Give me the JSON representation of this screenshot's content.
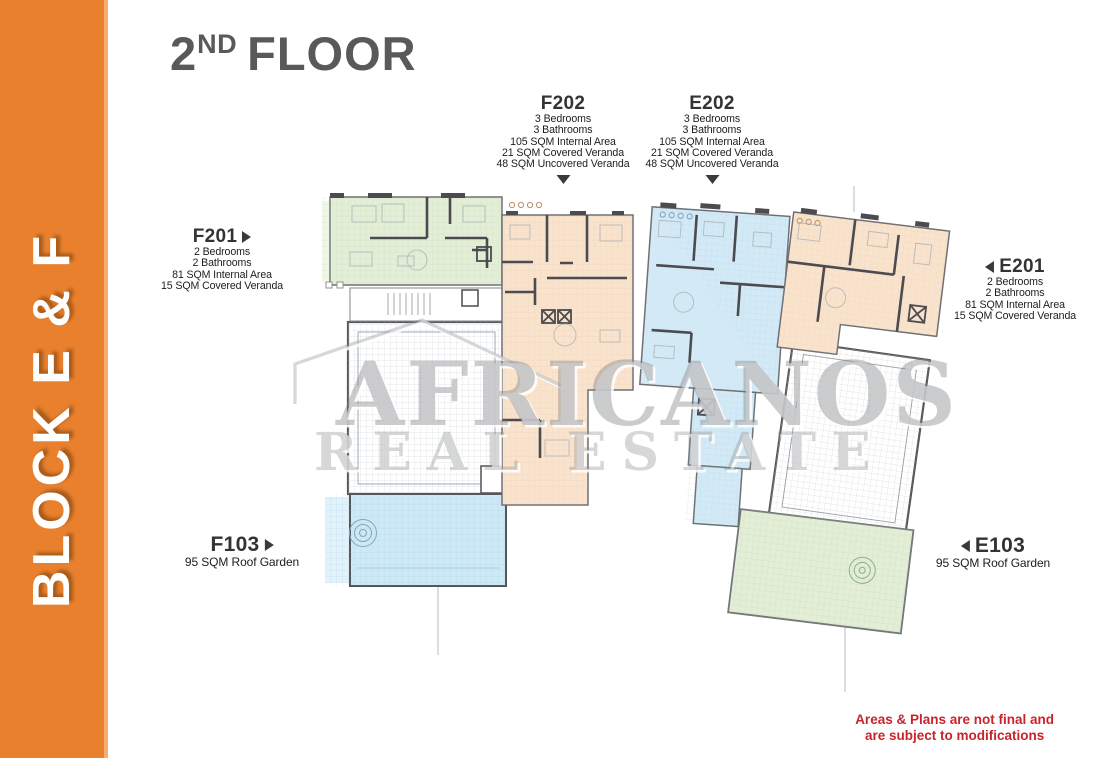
{
  "sidebar": {
    "label": "BLOCK E & F",
    "color": "#E8802E",
    "stripe_color": "#F5AD69",
    "text_color": "#FFFFFF"
  },
  "header": {
    "title_number": "2",
    "title_ordinal": "ND",
    "title_word": "FLOOR",
    "color": "#59595B"
  },
  "units": {
    "f202": {
      "name": "F202",
      "details": [
        "3 Bedrooms",
        "3 Bathrooms",
        "105 SQM Internal Area",
        "21 SQM Covered Veranda",
        "48 SQM Uncovered Veranda"
      ]
    },
    "e202": {
      "name": "E202",
      "details": [
        "3 Bedrooms",
        "3 Bathrooms",
        "105 SQM Internal Area",
        "21 SQM Covered Veranda",
        "48 SQM Uncovered Veranda"
      ]
    },
    "f201": {
      "name": "F201",
      "details": [
        "2 Bedrooms",
        "2 Bathrooms",
        "81 SQM Internal Area",
        "15 SQM Covered Veranda"
      ]
    },
    "e201": {
      "name": "E201",
      "details": [
        "2 Bedrooms",
        "2 Bathrooms",
        "81 SQM Internal Area",
        "15 SQM Covered Veranda"
      ]
    },
    "f103": {
      "name": "F103",
      "details": [
        "95 SQM Roof Garden"
      ]
    },
    "e103": {
      "name": "E103",
      "details": [
        "95 SQM Roof Garden"
      ]
    }
  },
  "watermark": {
    "line1": "AFRICANOS",
    "line2": "REAL ESTATE"
  },
  "disclaimer": {
    "line1": "Areas & Plans are not final and",
    "line2": "are subject to modifications",
    "color": "#C8242B"
  },
  "plan": {
    "colors": {
      "green": "#E3EED7",
      "peach": "#F9E3CD",
      "blue": "#D3EAF6",
      "blue_roof": "#CDE9F6",
      "green_roof": "#E3EED7",
      "wall": "#4B4B50",
      "line": "#9AA0A6"
    }
  }
}
